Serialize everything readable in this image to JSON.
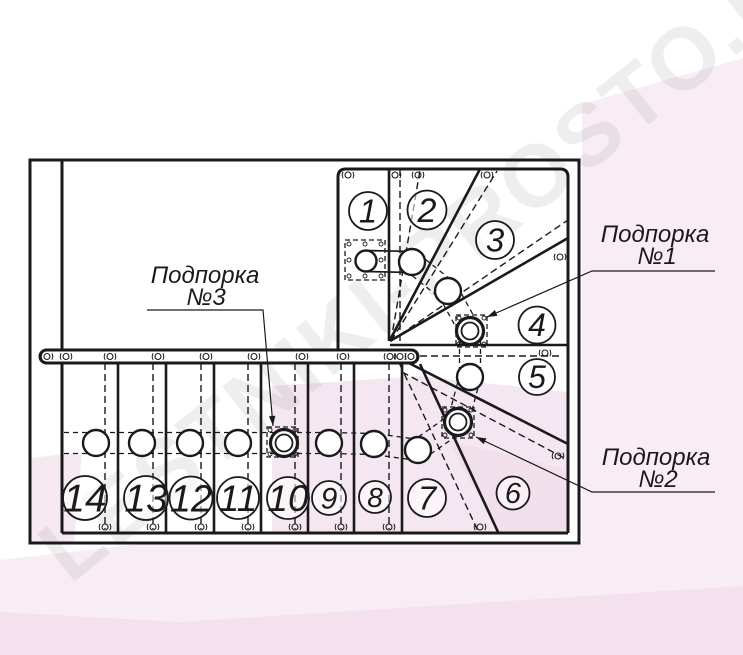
{
  "watermark": {
    "text": "LESTNIKI-PROSTO.RU",
    "angle": -38.5,
    "color": "#8a8a8a",
    "opacity": 0.14,
    "font_size": 88
  },
  "supports": [
    {
      "name": "Подпорка №1",
      "line1": "Подпорка",
      "line2": "№1"
    },
    {
      "name": "Подпорка №2",
      "line1": "Подпорка",
      "line2": "№2"
    },
    {
      "name": "Подпорка №3",
      "line1": "Подпорка",
      "line2": "№3"
    }
  ],
  "steps": [
    {
      "n": "1",
      "x": 368,
      "y": 211,
      "r": 19
    },
    {
      "n": "2",
      "x": 427,
      "y": 210,
      "r": 19.5
    },
    {
      "n": "3",
      "x": 495,
      "y": 240,
      "r": 19
    },
    {
      "n": "4",
      "x": 537,
      "y": 325,
      "r": 18.5
    },
    {
      "n": "5",
      "x": 537,
      "y": 377,
      "r": 18
    },
    {
      "n": "6",
      "x": 513,
      "y": 493,
      "r": 16.5
    },
    {
      "n": "7",
      "x": 427,
      "y": 498,
      "r": 19
    },
    {
      "n": "8",
      "x": 375,
      "y": 497,
      "r": 16
    },
    {
      "n": "9",
      "x": 329,
      "y": 498,
      "r": 17
    },
    {
      "n": "10",
      "x": 288,
      "y": 498,
      "r": 21
    },
    {
      "n": "11",
      "x": 238,
      "y": 498,
      "r": 21
    },
    {
      "n": "12",
      "x": 191,
      "y": 498,
      "r": 21.5
    },
    {
      "n": "13",
      "x": 146,
      "y": 498,
      "r": 22
    },
    {
      "n": "14",
      "x": 85,
      "y": 498,
      "r": 22
    }
  ],
  "colors": {
    "line": "#1a1a1a",
    "white": "#ffffff",
    "pink_light": "#f8edf5",
    "pink_mid": "#f5e7f1",
    "pink_deep": "#f1dfeb",
    "pink_stripe": "#f2dcea"
  },
  "drawing": {
    "pink": [
      {
        "pts": "582,104 743,58 743,544 582,544",
        "fill": "#f8edf5"
      },
      {
        "pts": "272,386 420,376 568,392 568,533 272,533",
        "fill": "#f5e7f1"
      },
      {
        "pts": "30,458 82,452 74,544 30,544",
        "fill": "#f6e9f2"
      },
      {
        "pts": "0,560 140,544 743,544 743,655 0,655",
        "fill": "#f8edf5"
      },
      {
        "pts": "448,440 568,470 568,533 498,533",
        "fill": "#f1dfeb"
      },
      {
        "pts": "0,655 0,612 180,622 743,586 743,655",
        "fill": "#f2dcea",
        "op": 0.7
      }
    ],
    "border_paths": [
      "M30,160 H579 V543 H30 Z",
      "M62,160 V533",
      "M62,533 H568",
      "M568,533 V177 Q568,169 560,169 H346 Q338,169 338,177 V352"
    ],
    "solid": [
      [
        118,
        363,
        118,
        532
      ],
      [
        166,
        363,
        166,
        532
      ],
      [
        214,
        363,
        214,
        532
      ],
      [
        261,
        363,
        261,
        532
      ],
      [
        308,
        363,
        308,
        532
      ],
      [
        354,
        363,
        354,
        532
      ],
      [
        402,
        363,
        402,
        532
      ],
      [
        420,
        364,
        498,
        532
      ],
      [
        389,
        169,
        389,
        341
      ],
      [
        390,
        340,
        480,
        169
      ],
      [
        390,
        341,
        568,
        238
      ],
      [
        390,
        345,
        568,
        345
      ],
      [
        397,
        357,
        568,
        444
      ]
    ],
    "dashed": [
      [
        400,
        169,
        400,
        341
      ],
      [
        105,
        363,
        105,
        529
      ],
      [
        153,
        363,
        153,
        529
      ],
      [
        201,
        363,
        201,
        529
      ],
      [
        248,
        363,
        248,
        529
      ],
      [
        295,
        363,
        295,
        529
      ],
      [
        341,
        363,
        341,
        529
      ],
      [
        389,
        363,
        389,
        529
      ],
      [
        391,
        341,
        420,
        170
      ],
      [
        391,
        341,
        497,
        171
      ],
      [
        391,
        341,
        568,
        220
      ],
      [
        420,
        356,
        560,
        356
      ],
      [
        402,
        372,
        568,
        460
      ],
      [
        395,
        354,
        478,
        531
      ]
    ],
    "rail": {
      "x": 40,
      "y": 350,
      "w": 378,
      "h": 13,
      "rx": 6.5
    },
    "rail_fittings_y": 356.5,
    "rail_fittings_x": [
      47,
      66,
      110,
      158,
      206,
      254,
      302,
      343,
      390,
      400,
      411
    ],
    "fittings": [
      [
        348,
        175
      ],
      [
        395,
        175
      ],
      [
        418,
        175
      ],
      [
        487,
        175
      ],
      [
        560,
        257
      ],
      [
        545,
        353
      ],
      [
        558,
        456
      ],
      [
        480,
        527
      ],
      [
        105,
        527
      ],
      [
        153,
        527
      ],
      [
        201,
        527
      ],
      [
        248,
        527
      ],
      [
        295,
        527
      ],
      [
        341,
        527
      ],
      [
        389,
        527
      ]
    ],
    "handrail": {
      "offset": 10.5,
      "pts": [
        [
          366,
          261
        ],
        [
          412,
          262
        ],
        [
          448,
          291
        ],
        [
          470,
          331
        ],
        [
          470,
          377
        ],
        [
          458,
          422
        ],
        [
          418,
          450
        ],
        [
          374,
          444
        ],
        [
          329,
          443
        ],
        [
          284,
          443
        ],
        [
          238,
          443
        ],
        [
          190,
          443
        ],
        [
          142,
          443
        ],
        [
          96,
          443
        ],
        [
          62,
          443
        ]
      ]
    },
    "balusters": [
      [
        412,
        262
      ],
      [
        448,
        291
      ],
      [
        470,
        377
      ],
      [
        418,
        450
      ],
      [
        374,
        444
      ],
      [
        329,
        443
      ],
      [
        238,
        443
      ],
      [
        190,
        443
      ],
      [
        142,
        443
      ],
      [
        96,
        443
      ]
    ],
    "baluster_r": 13,
    "top_post": {
      "x": 366,
      "y": 261,
      "r": 10.5,
      "box": [
        345,
        240,
        40,
        40
      ]
    },
    "support_posts": [
      {
        "x": 470,
        "y": 331,
        "box": [
          456,
          315,
          31,
          32
        ]
      },
      {
        "x": 458,
        "y": 422,
        "box": [
          442,
          407,
          32,
          31
        ]
      },
      {
        "x": 284,
        "y": 443,
        "box": [
          267,
          427,
          31,
          30
        ]
      }
    ],
    "leaders": [
      {
        "pts": [
          [
            715,
            271
          ],
          [
            592,
            271
          ],
          [
            487,
            317
          ]
        ]
      },
      {
        "pts": [
          [
            715,
            492
          ],
          [
            592,
            492
          ],
          [
            476,
            437
          ]
        ]
      },
      {
        "pts": [
          [
            147,
            310
          ],
          [
            263,
            310
          ],
          [
            273,
            426
          ]
        ]
      }
    ]
  }
}
